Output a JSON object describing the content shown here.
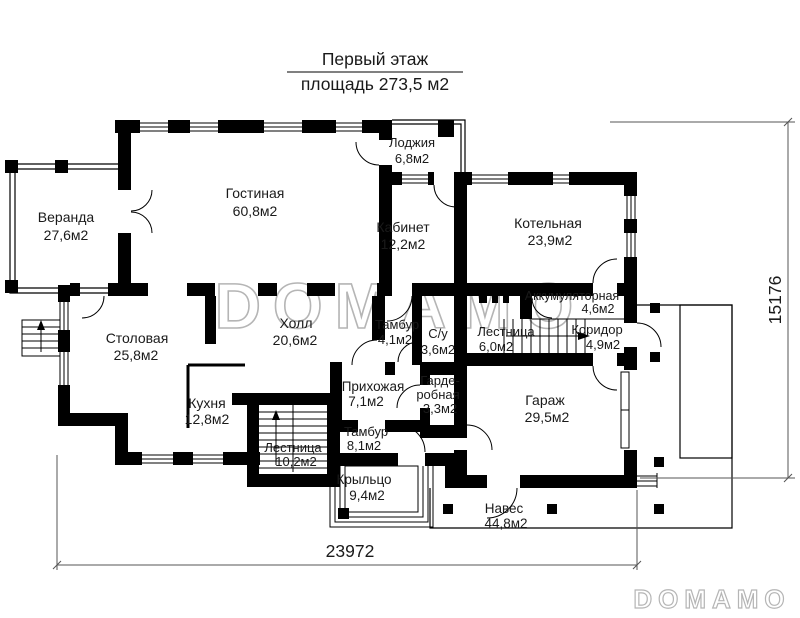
{
  "title": {
    "line1": "Первый этаж",
    "line2": "площадь 273,5 м2"
  },
  "rooms": {
    "veranda": {
      "name": "Веранда",
      "area": "27,6м2"
    },
    "living": {
      "name": "Гостиная",
      "area": "60,8м2"
    },
    "loggia": {
      "name": "Лоджия",
      "area": "6,8м2"
    },
    "office": {
      "name": "Кабинет",
      "area": "12,2м2"
    },
    "boiler": {
      "name": "Котельная",
      "area": "23,9м2"
    },
    "battery": {
      "name": "Аккумуляторная",
      "area": "4,6м2"
    },
    "dining": {
      "name": "Столовая",
      "area": "25,8м2"
    },
    "hall": {
      "name": "Холл",
      "area": "20,6м2"
    },
    "vestibule1": {
      "name": "Тамбур",
      "area": "4,1м2"
    },
    "wc": {
      "name": "С/у",
      "area": "3,6м2"
    },
    "stairs1": {
      "name": "Лестница",
      "area": "6,0м2"
    },
    "corridor": {
      "name": "Коридор",
      "area": "4,9м2"
    },
    "kitchen": {
      "name": "Кухня",
      "area": "12,8м2"
    },
    "entry": {
      "name": "Прихожая",
      "area": "7,1м2"
    },
    "wardrobe": {
      "name1": "Гарде-",
      "name2": "робная",
      "area": "3,3м2"
    },
    "garage": {
      "name": "Гараж",
      "area": "29,5м2"
    },
    "stairs2": {
      "name": "Лестница",
      "area": "10,2м2"
    },
    "vestibule2": {
      "name": "Тамбур",
      "area": "8,1м2"
    },
    "porch": {
      "name": "Крыльцо",
      "area": "9,4м2"
    },
    "canopy": {
      "name": "Навес",
      "area": "44,8м2"
    }
  },
  "dimensions": {
    "width_mm": "23972",
    "height_mm": "15176"
  },
  "watermark": {
    "center": "DOMAMO",
    "corner": "DOMAMO"
  },
  "colors": {
    "wall": "#000000",
    "dimension_line": "#555555",
    "watermark_outline": "#b5b5b5"
  }
}
